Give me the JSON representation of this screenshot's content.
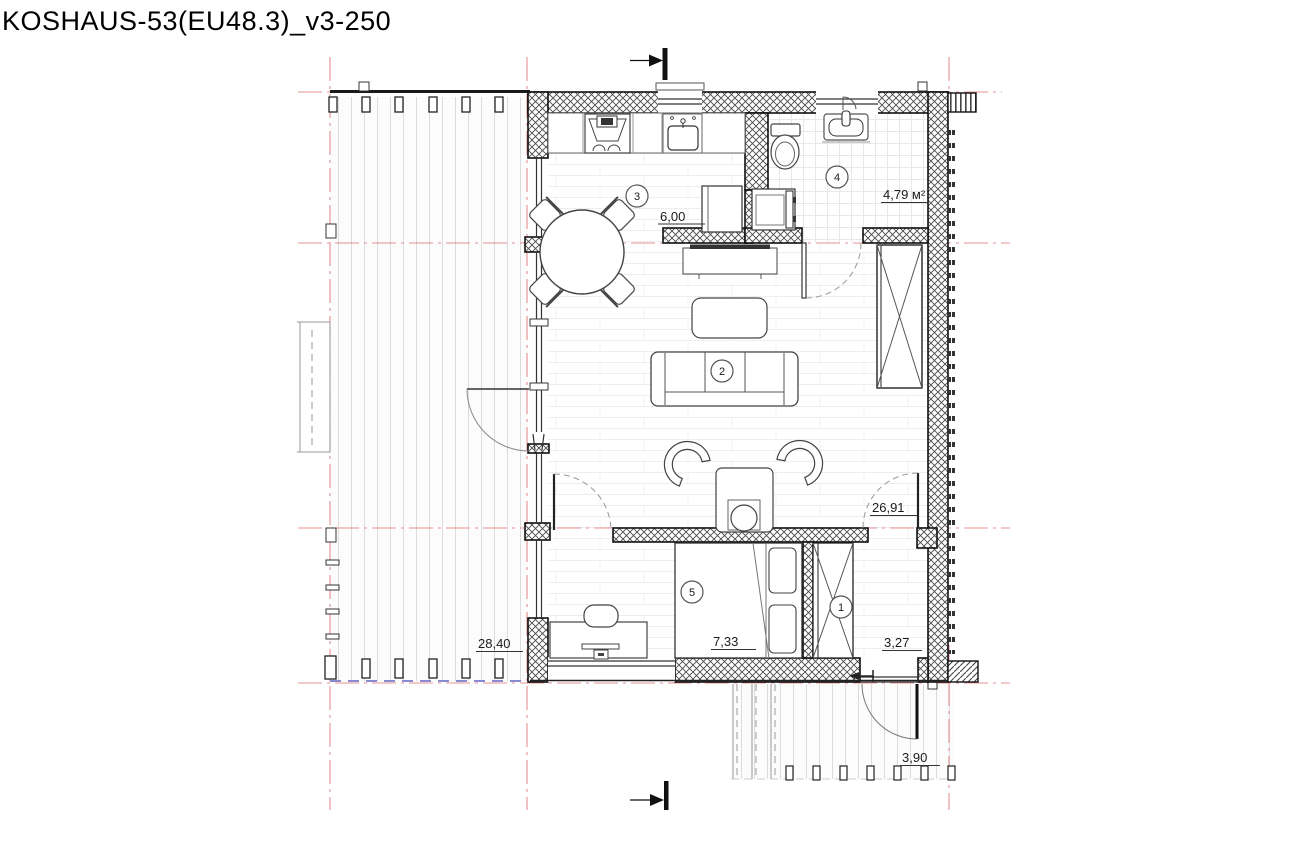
{
  "title": "KOSHAUS-53(EU48.3)_v3-250",
  "rooms": [
    {
      "id": "entry-hall",
      "number": "1",
      "dim": "3,27"
    },
    {
      "id": "living-room",
      "number": "2",
      "dim": "26,91"
    },
    {
      "id": "kitchen",
      "number": "3",
      "dim": "6,00"
    },
    {
      "id": "bathroom",
      "number": "4",
      "dim": "4,79 м²"
    },
    {
      "id": "bedroom",
      "number": "5",
      "dim": "7,33"
    }
  ],
  "outdoor": [
    {
      "id": "terrace-left",
      "dim": "28,40"
    },
    {
      "id": "porch-bottom",
      "dim": "3,90"
    }
  ],
  "colors": {
    "axis_red": "#e59090",
    "boundary_violet": "#8a8ad0",
    "wall_black": "#111111"
  }
}
